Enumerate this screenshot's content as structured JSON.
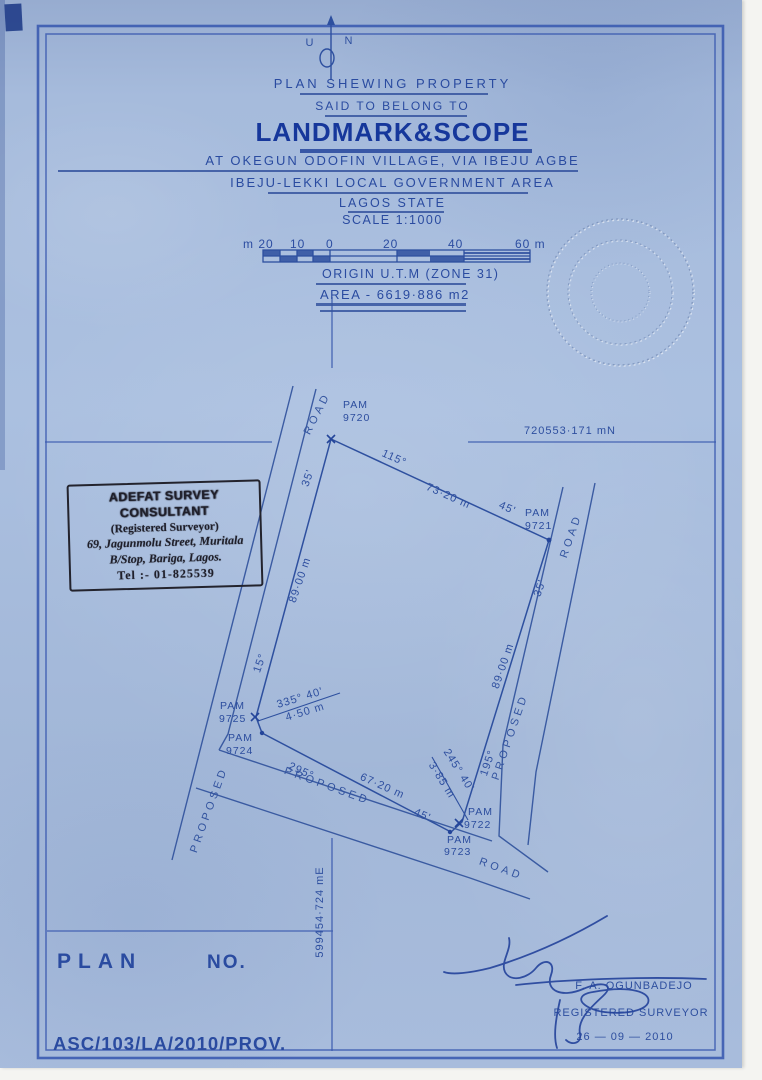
{
  "north_arrow": {
    "left": "U",
    "right": "N"
  },
  "title_block": {
    "line1": "PLAN  SHEWING  PROPERTY",
    "line2": "SAID TO BELONG TO",
    "owner": "LANDMARK&SCOPE",
    "line4": "AT  OKEGUN  ODOFIN  VILLAGE, VIA  IBEJU  AGBE",
    "line5": "IBEJU-LEKKI  LOCAL  GOVERNMENT  AREA",
    "line6": "LAGOS  STATE",
    "line7": "SCALE 1:1000"
  },
  "scale_bar": {
    "labels": [
      "m 20",
      "10",
      "0",
      "20",
      "40",
      "60 m"
    ]
  },
  "origin_line": "ORIGIN  U.T.M (ZONE 31)",
  "area_line": "AREA - 6619·886 m2",
  "grid": {
    "northing": "720553·171 mN",
    "easting": "599454·724 mE"
  },
  "stamp": {
    "line1": "ADEFAT SURVEY CONSULTANT",
    "line2": "(Registered  Surveyor)",
    "line3": "69, Jagunmolu Street, Muritala",
    "line4": "B/Stop, Bariga, Lagos.",
    "line5": "Tel :- 01-825539"
  },
  "diagram": {
    "beacons": [
      {
        "label": "PAM",
        "id": "9720"
      },
      {
        "label": "PAM",
        "id": "9721"
      },
      {
        "label": "PAM",
        "id": "9722"
      },
      {
        "label": "PAM",
        "id": "9723"
      },
      {
        "label": "PAM",
        "id": "9724"
      },
      {
        "label": "PAM",
        "id": "9725"
      }
    ],
    "labels": [
      "115°",
      "73·20 m",
      "45'",
      "35'",
      "89·00 m",
      "195°",
      "PROPOSED",
      "ROAD",
      "245° 40'",
      "3·85 m",
      "295°",
      "67·20 m",
      "45'",
      "335° 40'",
      "4·50 m",
      "15°",
      "89·00 m",
      "35'",
      "ROAD",
      "PROPOSED",
      "PROPOSED",
      "ROAD"
    ]
  },
  "footer": {
    "plan": "PLAN",
    "no": "NO.",
    "plan_number": "ASC/103/LA/2010/PROV."
  },
  "signature": {
    "name": "F. A. OGUNBADEJO",
    "title": "REGISTERED  SURVEYOR",
    "date": "26 — 09 — 2010"
  }
}
